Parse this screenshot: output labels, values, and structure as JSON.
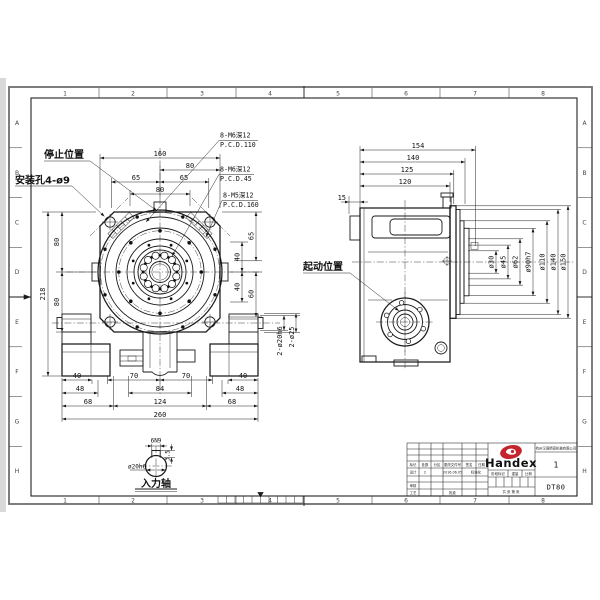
{
  "frame": {
    "columns": [
      "1",
      "2",
      "3",
      "4",
      "5",
      "6",
      "7",
      "8"
    ],
    "rows": [
      "A",
      "B",
      "C",
      "D",
      "E",
      "F",
      "G",
      "H"
    ]
  },
  "front": {
    "labels": {
      "stop": "停止位置",
      "mount": "安装孔4-ø9"
    },
    "notes": [
      {
        "l1": "8-M6深12",
        "l2": "P.C.D.110"
      },
      {
        "l1": "8-M6深12",
        "l2": "P.C.D.45"
      },
      {
        "l1": "8-M5深12",
        "l2": "P.C.D.160"
      }
    ],
    "dims": {
      "w160": "160",
      "t80r": "80",
      "t65l": "65",
      "t65r": "65",
      "t80c": "80",
      "h218": "218",
      "l80a": "80",
      "l80b": "80",
      "r65": "65",
      "r40a": "40",
      "r40b": "40",
      "r60": "60",
      "b40l": "40",
      "b70l": "70",
      "b70r": "70",
      "b40r": "40",
      "b48l": "48",
      "b84": "84",
      "b48r": "48",
      "b68l": "68",
      "b124": "124",
      "b68r": "68",
      "b260": "260"
    },
    "shaft_dims": {
      "d20": "2-ø20h6",
      "d25": "2-ø25"
    }
  },
  "side": {
    "label_start": "起动位置",
    "dims": {
      "d154": "154",
      "d140": "140",
      "d125": "125",
      "d120": "120",
      "d15": "15"
    },
    "diameters": {
      "d30": "ø30",
      "d45": "ø45",
      "d62": "ø62",
      "d90": "ø90h7",
      "d110": "ø110",
      "d140": "ø140",
      "d150": "ø150"
    }
  },
  "shaft_detail": {
    "key": "6N9",
    "depth": "3.5",
    "dia": "ø20h6",
    "label": "入力轴"
  },
  "title_block": {
    "brand": "Handex",
    "company": "杭州汉德精密机械有限公司",
    "qty": "1",
    "model": "DT80",
    "rev_headers": [
      "标记",
      "处数",
      "分区",
      "更改文件号",
      "签名",
      "日期"
    ],
    "row_design": {
      "c1": "设计",
      "c2": "2",
      "c3": "2016.06.05",
      "c4": "标准化"
    },
    "row_audit": "审核",
    "row_craft": "工艺",
    "row_approve": "批准",
    "stage": {
      "s1": "阶段标记",
      "s2": "重量",
      "s3": "比例"
    },
    "sheet_note": "共 张 第 张"
  }
}
